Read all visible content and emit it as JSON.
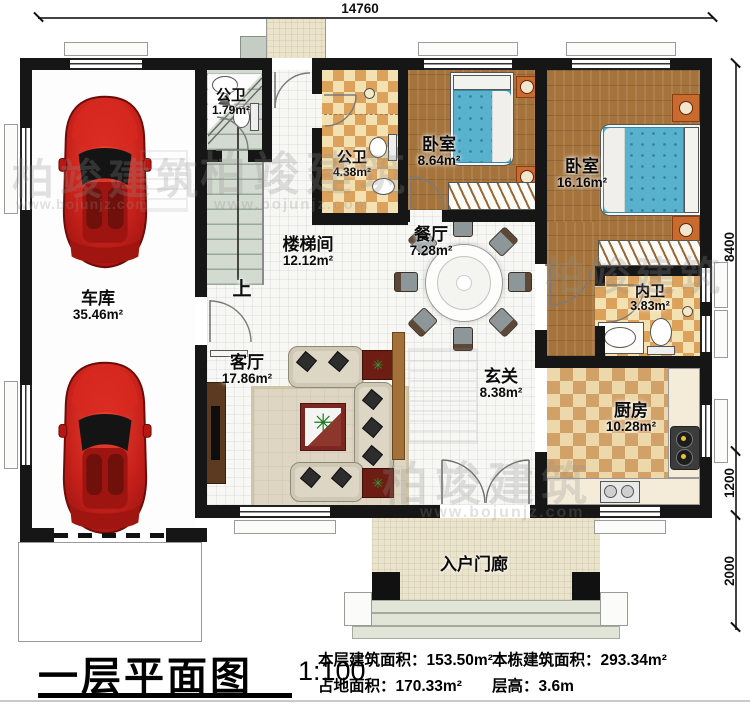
{
  "plan": {
    "top_dimension": "14760",
    "right_dimensions": [
      "8400",
      "1200",
      "2000"
    ],
    "stair_up_label": "上",
    "rooms": {
      "garage": {
        "name": "车库",
        "area": "35.46m²"
      },
      "bath_small": {
        "name": "公卫",
        "area": "1.79m²"
      },
      "bath_public": {
        "name": "公卫",
        "area": "4.38m²"
      },
      "bedroom_left": {
        "name": "卧室",
        "area": "8.64m²"
      },
      "bedroom_master": {
        "name": "卧室",
        "area": "16.16m²"
      },
      "stairwell": {
        "name": "楼梯间",
        "area": "12.12m²"
      },
      "dining": {
        "name": "餐厅",
        "area": "7.28m²"
      },
      "ensuite": {
        "name": "内卫",
        "area": "3.83m²"
      },
      "living": {
        "name": "客厅",
        "area": "17.86m²"
      },
      "foyer": {
        "name": "玄关",
        "area": "8.38m²"
      },
      "kitchen": {
        "name": "厨房",
        "area": "10.28m²"
      },
      "porch": {
        "name": "入户门廊"
      }
    }
  },
  "title_block": {
    "title": "一层平面图",
    "scale": "1:100",
    "stats": {
      "floor_area_label": "本层建筑面积：",
      "floor_area_value": "153.50m²",
      "land_area_label": "占地面积：",
      "land_area_value": "170.33m²",
      "total_area_label": "本栋建筑面积：",
      "total_area_value": "293.34m²",
      "height_label": "层高：",
      "height_value": "3.6m"
    }
  },
  "watermark": {
    "brand": "柏竣建筑",
    "url": "www.bojunjz.com"
  }
}
